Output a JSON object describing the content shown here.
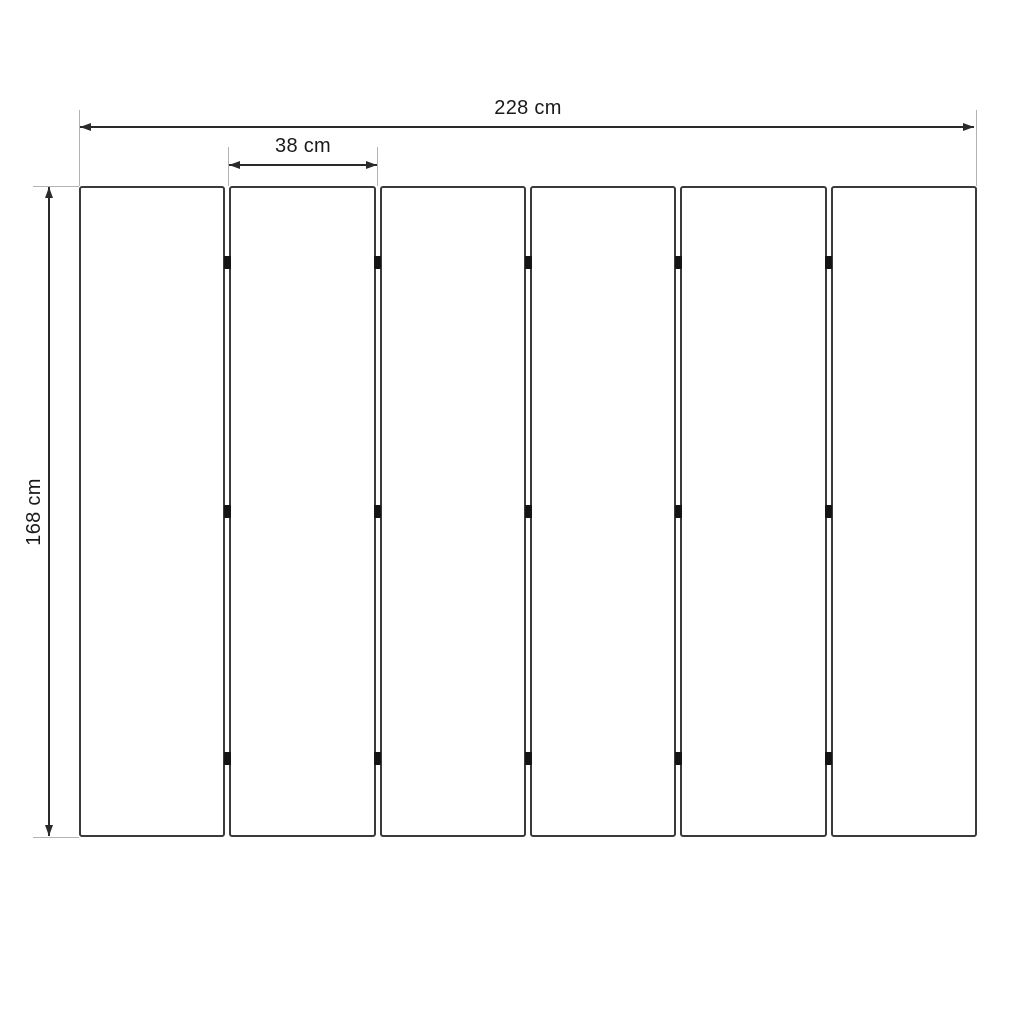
{
  "colors": {
    "background": "#ffffff",
    "panel_stroke": "#3a3a3a",
    "dimension_line": "#2a2a2a",
    "extension_line": "#b3b3b3",
    "hinge_fill": "#141414",
    "text": "#1a1a1a"
  },
  "dimensions": {
    "total_width_label": "228 cm",
    "panel_width_label": "38 cm",
    "height_label": "168 cm"
  },
  "panels": {
    "count": 6,
    "hinges_per_junction": 3,
    "hinge_positions_pct": [
      11.7,
      50,
      87.9
    ]
  }
}
